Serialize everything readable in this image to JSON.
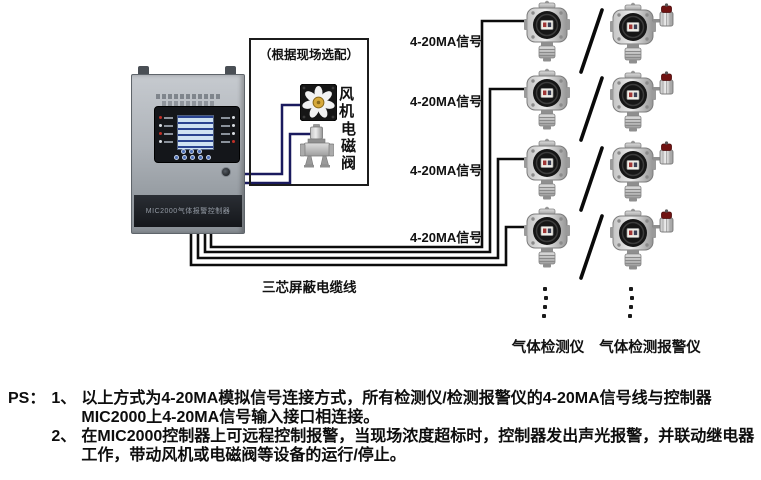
{
  "diagram": {
    "controller_label": "MIC2000气体报警控制器",
    "optional_box_title": "（根据现场选配）",
    "fan_label": "风机",
    "valve_label": "电磁阀",
    "signal_label": "4-20MA信号",
    "cable_label": "三芯屏蔽电缆线",
    "detector_caption": "气体检测仪",
    "alarm_caption": "气体检测报警仪",
    "colors": {
      "cable": "#0c0c0c",
      "device_wire": "#1a1a5e",
      "fan_hub": "#d7a93a",
      "alarm_cap": "#701312"
    }
  },
  "notes": {
    "prefix": "PS：",
    "items": [
      {
        "num": "1、",
        "text": "以上方式为4-20MA模拟信号连接方式，所有检测仪/检测报警仪的4-20MA信号线与控制器MIC2000上4-20MA信号输入接口相连接。"
      },
      {
        "num": "2、",
        "text": "在MIC2000控制器上可远程控制报警，当现场浓度超标时，控制器发出声光报警，并联动继电器工作，带动风机或电磁阀等设备的运行/停止。"
      }
    ]
  }
}
